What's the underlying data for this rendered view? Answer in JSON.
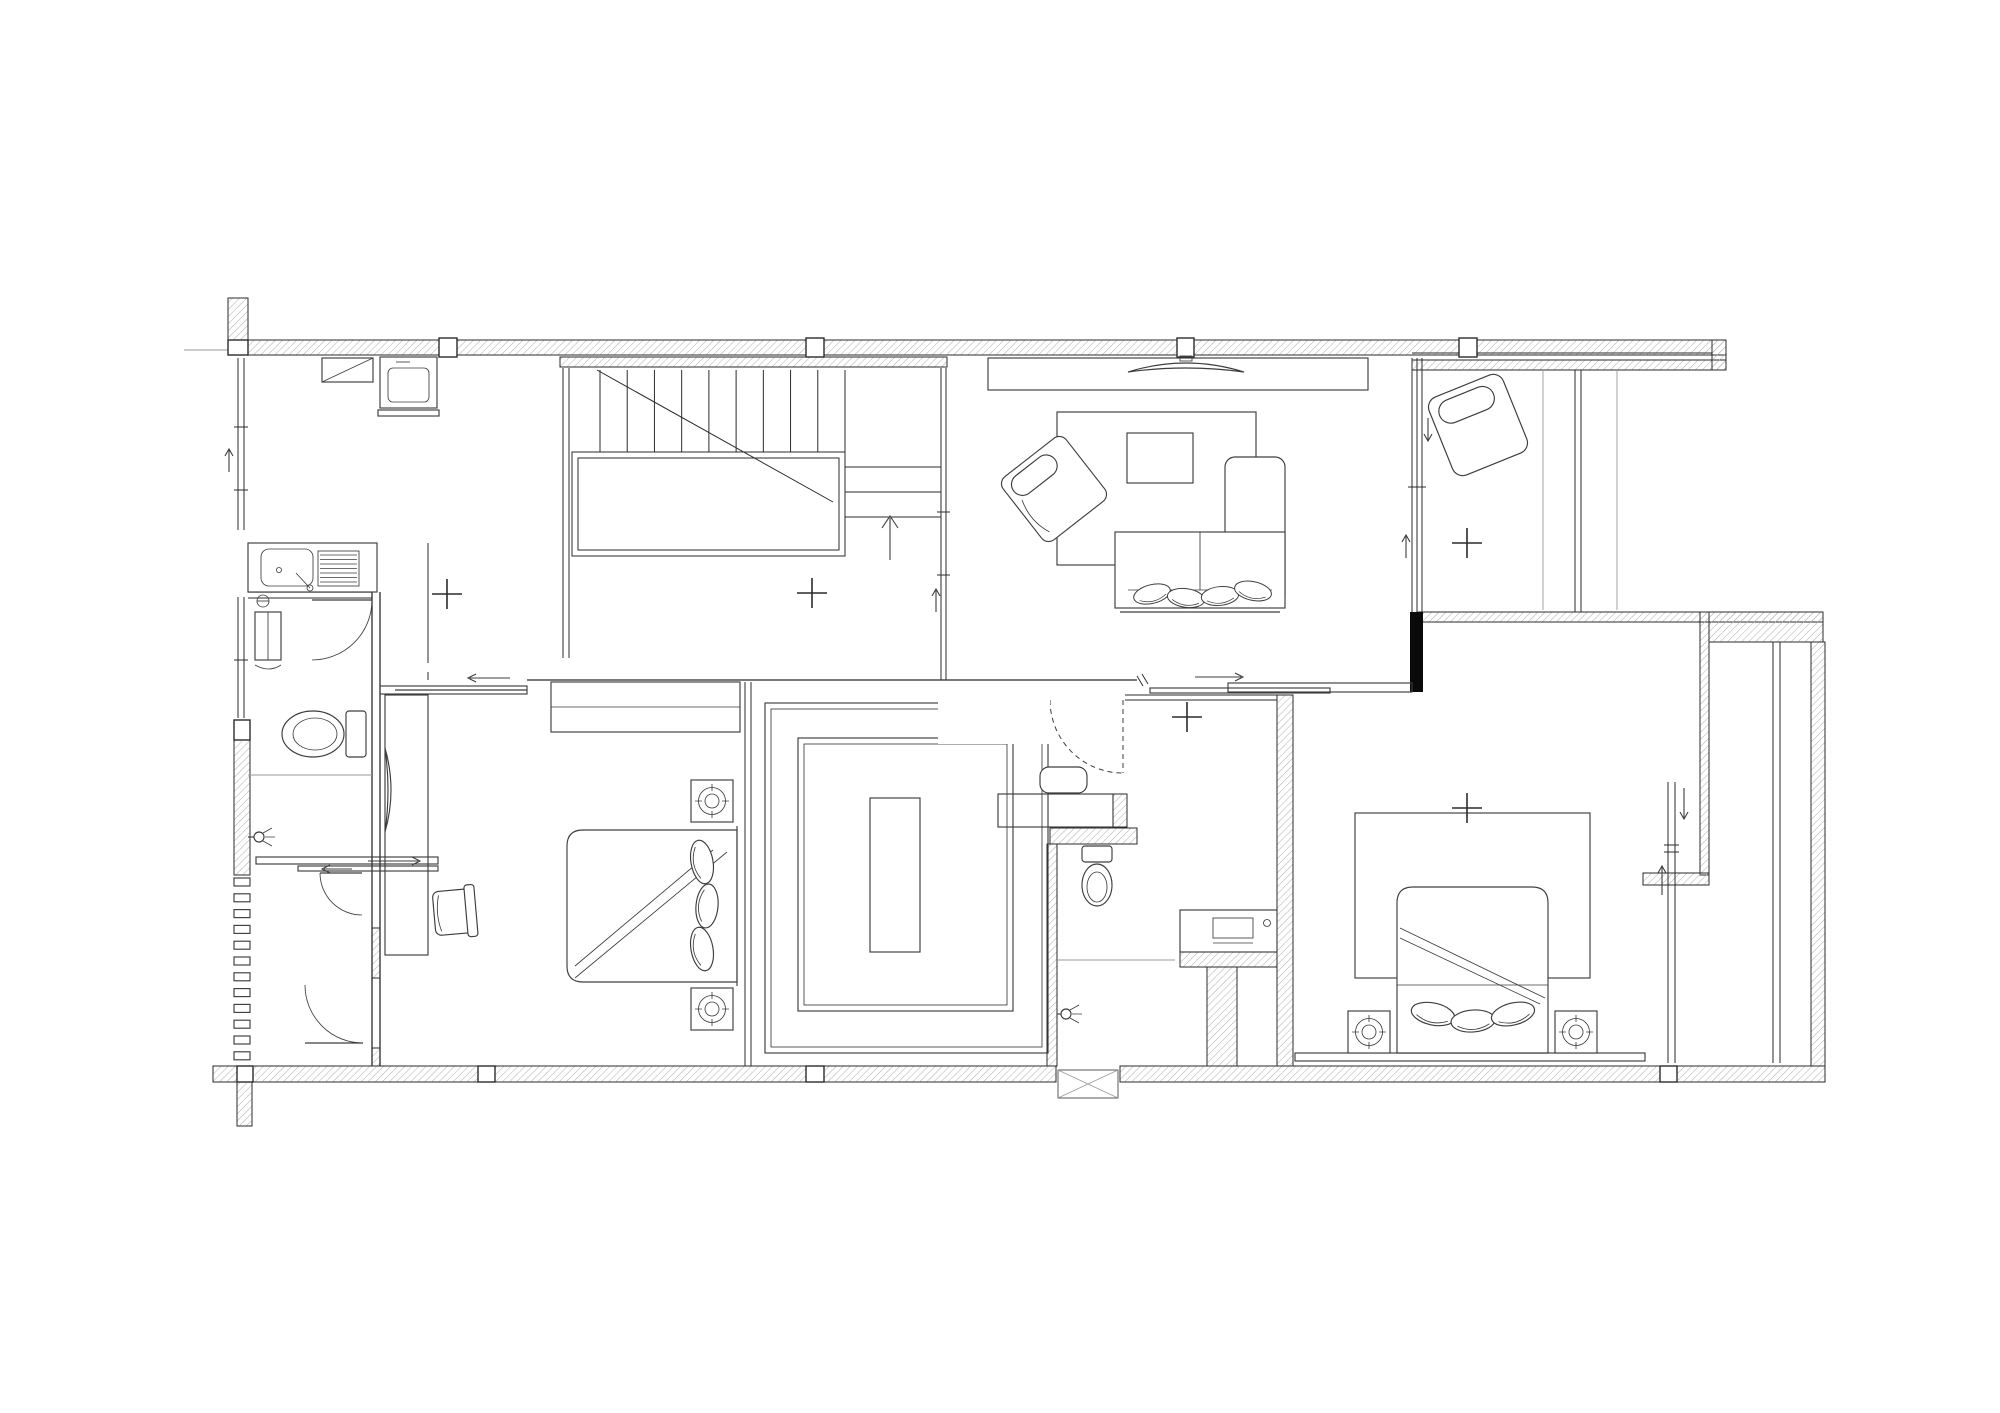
{
  "document": {
    "title": "",
    "type": "architectural-floor-plan",
    "visible_text": []
  },
  "canvas": {
    "width": 2000,
    "height": 1413
  },
  "colors": {
    "background": "#ffffff",
    "line": "#2b2b2b",
    "line_light": "#9a9a9a",
    "hatch": "#b3b3b3",
    "furniture": "#3d3d3d",
    "solid_wall": "#0a0a0a",
    "glass": "#6f6f6f"
  },
  "plan": {
    "cross_markers": [
      {
        "x": 447,
        "y": 594
      },
      {
        "x": 812,
        "y": 593
      },
      {
        "x": 1187,
        "y": 717
      },
      {
        "x": 1467,
        "y": 543
      },
      {
        "x": 1467,
        "y": 808
      }
    ],
    "stairs": {
      "tread_count": 10,
      "x_start": 600,
      "x_end": 845,
      "y_top": 370,
      "y_bottom": 452,
      "direction_arrow": "up"
    },
    "louver_slats": {
      "count": 12,
      "x": 234,
      "y_start": 878,
      "step": 15.8,
      "width": 16,
      "height": 8
    },
    "bedside_lamps": [
      {
        "x": 712,
        "y": 801
      },
      {
        "x": 712,
        "y": 1009
      },
      {
        "x": 1369,
        "y": 1032
      },
      {
        "x": 1576,
        "y": 1032
      }
    ],
    "rooms": [
      {
        "name": "kitchen-utility",
        "area": "top-left"
      },
      {
        "name": "stair-hall",
        "area": "top-center-left"
      },
      {
        "name": "living-room",
        "area": "top-center-right"
      },
      {
        "name": "lounge-room",
        "area": "top-right"
      },
      {
        "name": "bathroom-west",
        "area": "middle-left"
      },
      {
        "name": "entry-lobby",
        "area": "bottom-left"
      },
      {
        "name": "bedroom-west",
        "area": "bottom-center-left"
      },
      {
        "name": "walk-in-closet",
        "area": "bottom-center"
      },
      {
        "name": "bathroom-center",
        "area": "bottom-center-right"
      },
      {
        "name": "bedroom-east",
        "area": "bottom-right"
      },
      {
        "name": "terrace",
        "area": "right"
      }
    ],
    "fixtures": [
      "kitchen-sink",
      "wall-cabinet",
      "washing-machine",
      "toilet",
      "toilet",
      "shower-head",
      "shower-head",
      "washbasin-cabinet",
      "vanity-counter",
      "dressing-stool",
      "sofa-l-shape",
      "armchair",
      "lounge-chair",
      "coffee-table",
      "rug",
      "rug",
      "tv-panel",
      "tv-console",
      "double-bed",
      "double-bed",
      "bedside-table",
      "bedside-table",
      "bedside-table",
      "bedside-table",
      "desk",
      "desk-chair",
      "desk-tv",
      "dresser-cabinet",
      "wardrobe-u-shape",
      "wardrobe-island",
      "ac-outdoor-unit-box",
      "up-arrow",
      "door-swing",
      "sliding-door"
    ]
  }
}
